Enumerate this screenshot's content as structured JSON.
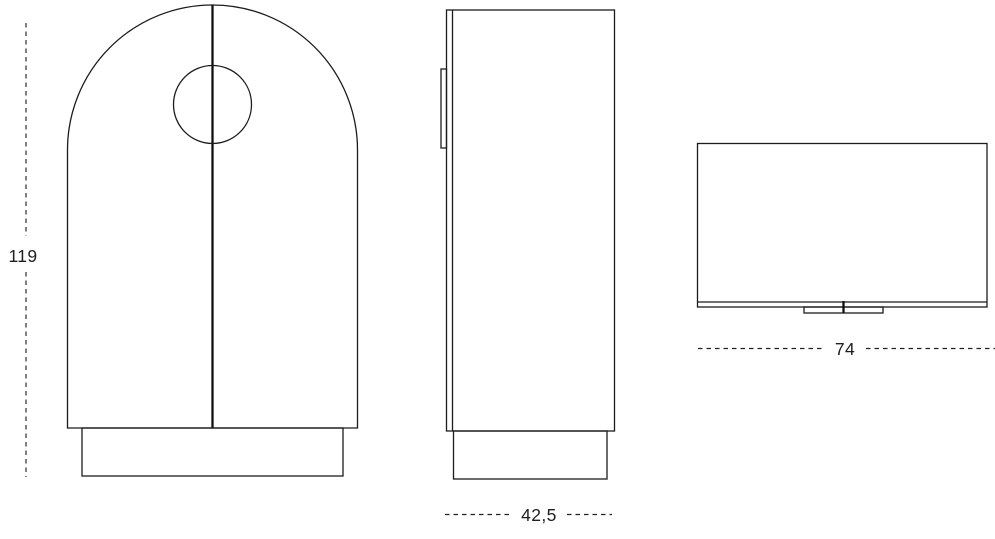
{
  "page": {
    "background": "#ffffff",
    "line_color": "#1c1c1c",
    "text_color": "#202020"
  },
  "drawing": {
    "type": "furniture-three-view-technical-drawing",
    "views": {
      "front": "arched cabinet front with two doors, round knob cutout and plinth",
      "side": "cabinet side profile with door edge, hinge detail and plinth",
      "top": "cabinet plan view with front door edge and handle detail"
    },
    "labels": {
      "height": "119",
      "depth": "42,5",
      "width": "74"
    }
  }
}
